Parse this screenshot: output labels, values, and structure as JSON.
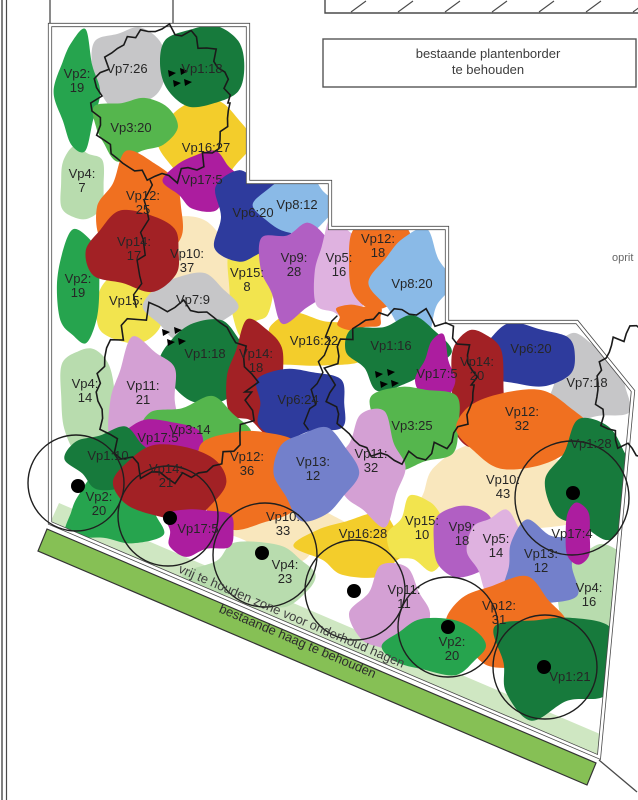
{
  "notes": {
    "planten_border": [
      "bestaande plantenborder",
      "te behouden"
    ],
    "oprit": "oprit",
    "zone": "vrij te houden zone voor onderhoud hagen",
    "haag": "bestaande haag te behouden"
  },
  "palette": {
    "vp1": "#177a3c",
    "vp2": "#26a44e",
    "vp3": "#55b64d",
    "vp4": "#b8dcae",
    "vp5": "#dfb2e0",
    "vp6": "#2e3b9d",
    "vp7": "#c6c6c8",
    "vp8": "#8abae7",
    "vp9": "#b15fc3",
    "vp10": "#f9e7bd",
    "vp11": "#d4a0d4",
    "vp12": "#f07020",
    "vp13": "#7380cb",
    "vp14": "#a22125",
    "vp15": "#f2e44e",
    "vp16": "#f3cd2b",
    "vp17": "#ac1d9f",
    "hedge_strip": "#86c055",
    "zone_band": "#cfe7c2",
    "line": "#4a4a4a"
  },
  "areas": [
    {
      "label": "Vp10:|37",
      "c": "vp10",
      "x": 188,
      "y": 272,
      "rx": 50,
      "ry": 54,
      "lx": 187,
      "ly": 258
    },
    {
      "label": "Vp10:|43",
      "c": "vp10",
      "x": 502,
      "y": 490,
      "rx": 86,
      "ry": 42,
      "lx": 503,
      "ly": 484
    },
    {
      "label": "Vp10:|33",
      "c": "vp10",
      "x": 283,
      "y": 527,
      "rx": 56,
      "ry": 33,
      "lx": 283,
      "ly": 521
    },
    {
      "label": "Vp4:|7",
      "c": "vp4",
      "x": 82,
      "y": 184,
      "rx": 23,
      "ry": 37,
      "lx": 82,
      "ly": 178
    },
    {
      "label": "Vp4:|14",
      "c": "vp4",
      "x": 86,
      "y": 398,
      "rx": 27,
      "ry": 52,
      "lx": 85,
      "ly": 388
    },
    {
      "label": "Vp4:|23",
      "c": "vp4",
      "x": 258,
      "y": 574,
      "rx": 66,
      "ry": 29,
      "lx": 285,
      "ly": 569
    },
    {
      "label": "Vp4:|16",
      "c": "vp4",
      "x": 592,
      "y": 598,
      "rx": 37,
      "ry": 56,
      "lx": 589,
      "ly": 592
    },
    {
      "label": "Vp16:27",
      "c": "vp16",
      "x": 204,
      "y": 142,
      "rx": 44,
      "ry": 42,
      "lx": 206,
      "ly": 152
    },
    {
      "label": "Vp16:22",
      "c": "vp16",
      "x": 311,
      "y": 342,
      "rx": 50,
      "ry": 27,
      "lx": 314,
      "ly": 345
    },
    {
      "label": "Vp16:28",
      "c": "vp16",
      "x": 360,
      "y": 546,
      "rx": 56,
      "ry": 29,
      "lx": 363,
      "ly": 538
    },
    {
      "label": "Vp15:",
      "c": "vp15",
      "x": 130,
      "y": 308,
      "rx": 35,
      "ry": 36,
      "lx": 126,
      "ly": 305
    },
    {
      "label": "Vp15:|8",
      "c": "vp15",
      "x": 249,
      "y": 286,
      "rx": 22,
      "ry": 46,
      "lx": 247,
      "ly": 277
    },
    {
      "label": "Vp15:|10",
      "c": "vp15",
      "x": 421,
      "y": 534,
      "rx": 31,
      "ry": 34,
      "lx": 422,
      "ly": 525
    },
    {
      "label": "Vp7:26",
      "c": "vp7",
      "x": 128,
      "y": 68,
      "rx": 37,
      "ry": 41,
      "lx": 127,
      "ly": 73
    },
    {
      "label": "Vp7:9",
      "c": "vp7",
      "x": 190,
      "y": 307,
      "rx": 43,
      "ry": 33,
      "lx": 193,
      "ly": 304
    },
    {
      "label": "Vp7:18",
      "c": "vp7",
      "x": 588,
      "y": 380,
      "rx": 42,
      "ry": 44,
      "lx": 587,
      "ly": 387
    },
    {
      "label": "Vp2:|19",
      "c": "vp2",
      "x": 78,
      "y": 92,
      "rx": 21,
      "ry": 56,
      "lx": 77,
      "ly": 78
    },
    {
      "label": "Vp2:|19",
      "c": "vp2",
      "x": 79,
      "y": 286,
      "rx": 22,
      "ry": 56,
      "lx": 78,
      "ly": 283
    },
    {
      "label": "Vp3:20",
      "c": "vp3",
      "x": 132,
      "y": 127,
      "rx": 39,
      "ry": 30,
      "lx": 131,
      "ly": 132
    },
    {
      "label": "Vp12:|25",
      "c": "vp12",
      "x": 143,
      "y": 207,
      "rx": 45,
      "ry": 49,
      "lx": 143,
      "ly": 200
    },
    {
      "label": "Vp1:18",
      "c": "vp1",
      "x": 202,
      "y": 66,
      "rx": 43,
      "ry": 41,
      "lx": 202,
      "ly": 73
    },
    {
      "label": "Vp17:5",
      "c": "vp17",
      "x": 203,
      "y": 181,
      "rx": 35,
      "ry": 28,
      "lx": 202,
      "ly": 184
    },
    {
      "label": "Vp6:20",
      "c": "vp6",
      "x": 252,
      "y": 217,
      "rx": 40,
      "ry": 46,
      "lx": 253,
      "ly": 217
    },
    {
      "label": "Vp8:12",
      "c": "vp8",
      "x": 296,
      "y": 205,
      "rx": 39,
      "ry": 28,
      "lx": 297,
      "ly": 209
    },
    {
      "label": "Vp14:|17",
      "c": "vp14",
      "x": 136,
      "y": 251,
      "rx": 49,
      "ry": 39,
      "lx": 134,
      "ly": 246
    },
    {
      "label": "Vp9:|28",
      "c": "vp9",
      "x": 296,
      "y": 270,
      "rx": 36,
      "ry": 46,
      "lx": 294,
      "ly": 262
    },
    {
      "label": "Vp5:|16",
      "c": "vp5",
      "x": 341,
      "y": 272,
      "rx": 27,
      "ry": 49,
      "lx": 339,
      "ly": 262
    },
    {
      "label": "Vp12:|18",
      "c": "vp12",
      "x": 381,
      "y": 262,
      "rx": 34,
      "ry": 49,
      "lx": 378,
      "ly": 243
    },
    {
      "label": "Vp8:20",
      "c": "vp8",
      "x": 413,
      "y": 283,
      "rx": 37,
      "ry": 49,
      "lx": 412,
      "ly": 288
    },
    {
      "label": "",
      "c": "vp12",
      "x": 358,
      "y": 317,
      "rx": 23,
      "ry": 13,
      "lx": 0,
      "ly": 0
    },
    {
      "label": "Vp1:18",
      "c": "vp1",
      "x": 207,
      "y": 362,
      "rx": 45,
      "ry": 41,
      "lx": 205,
      "ly": 358
    },
    {
      "label": "Vp14:|18",
      "c": "vp14",
      "x": 258,
      "y": 378,
      "rx": 31,
      "ry": 54,
      "lx": 256,
      "ly": 358
    },
    {
      "label": "Vp1:16",
      "c": "vp1",
      "x": 395,
      "y": 352,
      "rx": 47,
      "ry": 34,
      "lx": 391,
      "ly": 350
    },
    {
      "label": "Vp6:20",
      "c": "vp6",
      "x": 528,
      "y": 356,
      "rx": 50,
      "ry": 31,
      "lx": 531,
      "ly": 353
    },
    {
      "label": "Vp14:|20",
      "c": "vp14",
      "x": 477,
      "y": 388,
      "rx": 28,
      "ry": 60,
      "lx": 477,
      "ly": 366
    },
    {
      "label": "Vp17:5",
      "c": "vp17",
      "x": 437,
      "y": 380,
      "rx": 18,
      "ry": 41,
      "lx": 437,
      "ly": 378
    },
    {
      "label": "Vp3:25",
      "c": "vp3",
      "x": 413,
      "y": 426,
      "rx": 45,
      "ry": 43,
      "lx": 412,
      "ly": 430
    },
    {
      "label": "Vp12:|32",
      "c": "vp12",
      "x": 521,
      "y": 429,
      "rx": 63,
      "ry": 39,
      "lx": 522,
      "ly": 416
    },
    {
      "label": "Vp11:|21",
      "c": "vp11",
      "x": 146,
      "y": 400,
      "rx": 37,
      "ry": 56,
      "lx": 143,
      "ly": 390
    },
    {
      "label": "Vp3:14",
      "c": "vp3",
      "x": 194,
      "y": 433,
      "rx": 49,
      "ry": 33,
      "lx": 190,
      "ly": 434
    },
    {
      "label": "Vp17:5",
      "c": "vp17",
      "x": 161,
      "y": 441,
      "rx": 43,
      "ry": 21,
      "lx": 158,
      "ly": 442
    },
    {
      "label": "Vp6:24",
      "c": "vp6",
      "x": 299,
      "y": 403,
      "rx": 46,
      "ry": 36,
      "lx": 298,
      "ly": 404
    },
    {
      "label": "Vp11:|32",
      "c": "vp11",
      "x": 372,
      "y": 467,
      "rx": 35,
      "ry": 52,
      "lx": 371,
      "ly": 458
    },
    {
      "label": "Vp12:|36",
      "c": "vp12",
      "x": 249,
      "y": 478,
      "rx": 53,
      "ry": 51,
      "lx": 247,
      "ly": 461
    },
    {
      "label": "Vp13:|12",
      "c": "vp13",
      "x": 314,
      "y": 473,
      "rx": 39,
      "ry": 45,
      "lx": 313,
      "ly": 466
    },
    {
      "label": "Vp2:|20",
      "c": "vp2",
      "x": 116,
      "y": 512,
      "rx": 50,
      "ry": 33,
      "lx": 99,
      "ly": 501
    },
    {
      "label": "Vp1:10",
      "c": "vp1",
      "x": 110,
      "y": 459,
      "rx": 41,
      "ry": 29,
      "lx": 108,
      "ly": 460
    },
    {
      "label": "Vp14:|21",
      "c": "vp14",
      "x": 171,
      "y": 482,
      "rx": 56,
      "ry": 37,
      "lx": 166,
      "ly": 473
    },
    {
      "label": "Vp17:5",
      "c": "vp17",
      "x": 198,
      "y": 531,
      "rx": 34,
      "ry": 24,
      "lx": 198,
      "ly": 533
    },
    {
      "label": "Vp11:|11",
      "c": "vp11",
      "x": 394,
      "y": 613,
      "rx": 39,
      "ry": 45,
      "lx": 404,
      "ly": 594
    },
    {
      "label": "Vp9:|18",
      "c": "vp9",
      "x": 463,
      "y": 541,
      "rx": 31,
      "ry": 37,
      "lx": 462,
      "ly": 531
    },
    {
      "label": "Vp5:|14",
      "c": "vp5",
      "x": 497,
      "y": 551,
      "rx": 28,
      "ry": 39,
      "lx": 496,
      "ly": 543
    },
    {
      "label": "Vp13:|12",
      "c": "vp13",
      "x": 541,
      "y": 566,
      "rx": 38,
      "ry": 41,
      "lx": 541,
      "ly": 558
    },
    {
      "label": "Vp12:|31",
      "c": "vp12",
      "x": 507,
      "y": 623,
      "rx": 56,
      "ry": 43,
      "lx": 499,
      "ly": 610
    },
    {
      "label": "Vp2:|20",
      "c": "vp2",
      "x": 437,
      "y": 646,
      "rx": 51,
      "ry": 27,
      "lx": 452,
      "ly": 646
    },
    {
      "label": "Vp1:21",
      "c": "vp1",
      "x": 553,
      "y": 663,
      "rx": 59,
      "ry": 51,
      "lx": 570,
      "ly": 681
    },
    {
      "label": "Vp1:28",
      "c": "vp1",
      "x": 594,
      "y": 480,
      "rx": 45,
      "ry": 56,
      "lx": 591,
      "ly": 448
    },
    {
      "label": "Vp17:4",
      "c": "vp17",
      "x": 578,
      "y": 534,
      "rx": 13,
      "ry": 32,
      "lx": 572,
      "ly": 538
    }
  ],
  "tree_circles": [
    {
      "cx": 76,
      "cy": 483,
      "r": 48,
      "dx": 78,
      "dy": 486
    },
    {
      "cx": 168,
      "cy": 516,
      "r": 50,
      "dx": 170,
      "dy": 518
    },
    {
      "cx": 265,
      "cy": 555,
      "r": 52,
      "dx": 262,
      "dy": 553
    },
    {
      "cx": 355,
      "cy": 590,
      "r": 50,
      "dx": 354,
      "dy": 591
    },
    {
      "cx": 448,
      "cy": 627,
      "r": 50,
      "dx": 448,
      "dy": 627
    },
    {
      "cx": 545,
      "cy": 667,
      "r": 52,
      "dx": 544,
      "dy": 667
    },
    {
      "cx": 572,
      "cy": 498,
      "r": 57,
      "dx": 573,
      "dy": 493
    }
  ],
  "canopies": [
    {
      "cx": 162,
      "cy": 103,
      "rx": 67,
      "ry": 74
    },
    {
      "cx": 175,
      "cy": 392,
      "rx": 77,
      "ry": 86
    },
    {
      "cx": 402,
      "cy": 385,
      "rx": 72,
      "ry": 74
    },
    {
      "cx": 655,
      "cy": 390,
      "rx": 58,
      "ry": 66
    }
  ],
  "canopy_links": [
    {
      "x1": 150,
      "y1": 177,
      "x2": 136,
      "y2": 306
    },
    {
      "x1": 334,
      "y1": 314,
      "x2": 305,
      "y2": 431
    }
  ],
  "markers": [
    {
      "x": 175,
      "y": 75
    },
    {
      "x": 169,
      "y": 334
    },
    {
      "x": 382,
      "y": 376
    }
  ]
}
